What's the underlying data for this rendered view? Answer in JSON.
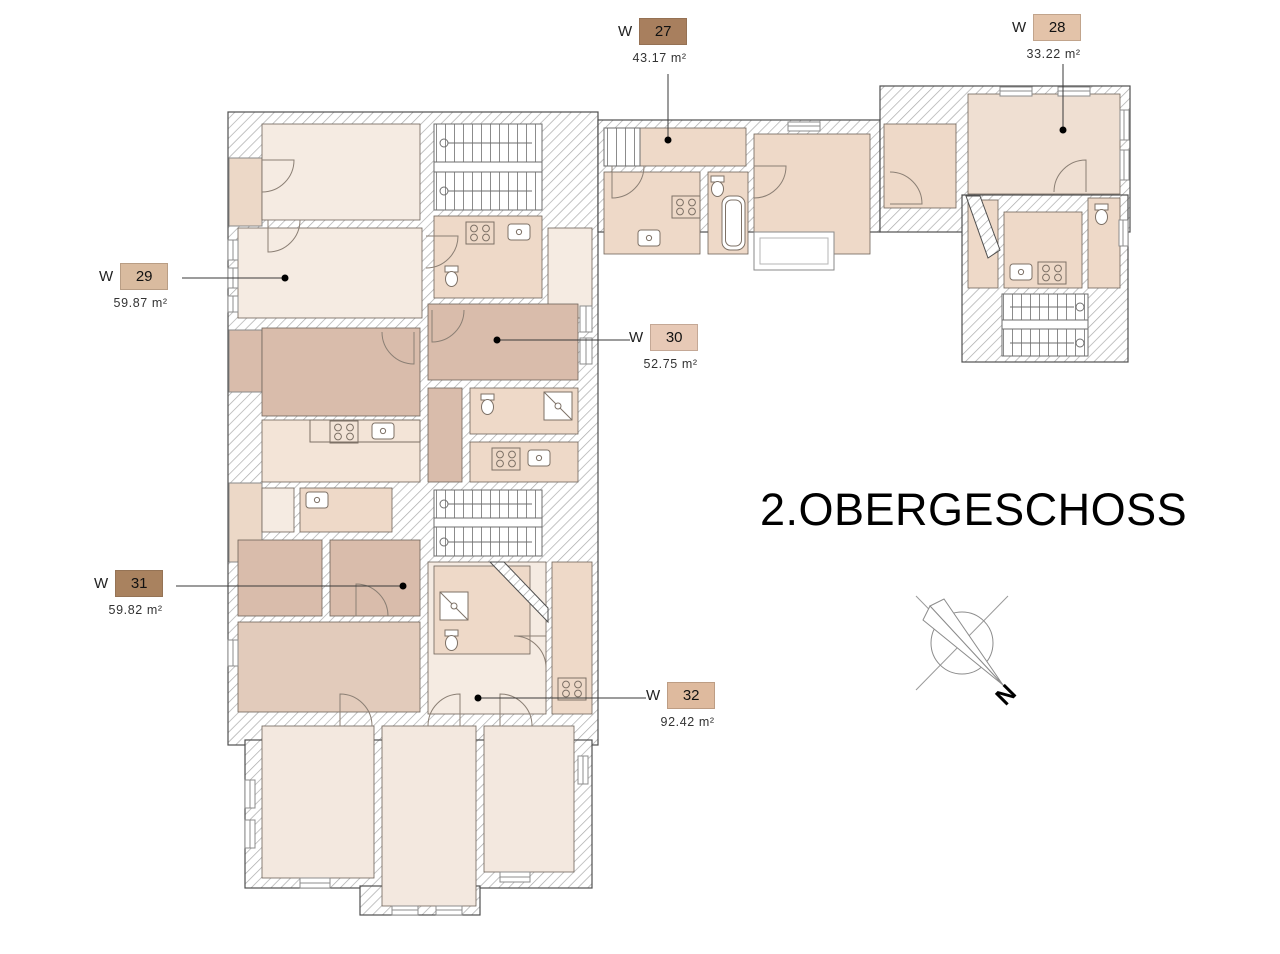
{
  "title": "2.OBERGESCHOSS",
  "compass": {
    "label": "N"
  },
  "units": [
    {
      "prefix": "W",
      "number": "27",
      "area": "43.17 m²",
      "swatch": "#a87f5e"
    },
    {
      "prefix": "W",
      "number": "28",
      "area": "33.22 m²",
      "swatch": "#e3c3a9"
    },
    {
      "prefix": "W",
      "number": "29",
      "area": "59.87 m²",
      "swatch": "#d9bb9f"
    },
    {
      "prefix": "W",
      "number": "30",
      "area": "52.75 m²",
      "swatch": "#e7c9b6"
    },
    {
      "prefix": "W",
      "number": "31",
      "area": "59.82 m²",
      "swatch": "#a9825f"
    },
    {
      "prefix": "W",
      "number": "32",
      "area": "92.42 m²",
      "swatch": "#deba9e"
    }
  ],
  "palette": {
    "room_cream": "#f5ebe2",
    "room_cream2": "#f3e4d7",
    "room_tan": "#eed9c8",
    "room_dusty": "#d9bcab",
    "room_dusty2": "#e2cbbb",
    "wall_outline": "#4f4f4f"
  }
}
